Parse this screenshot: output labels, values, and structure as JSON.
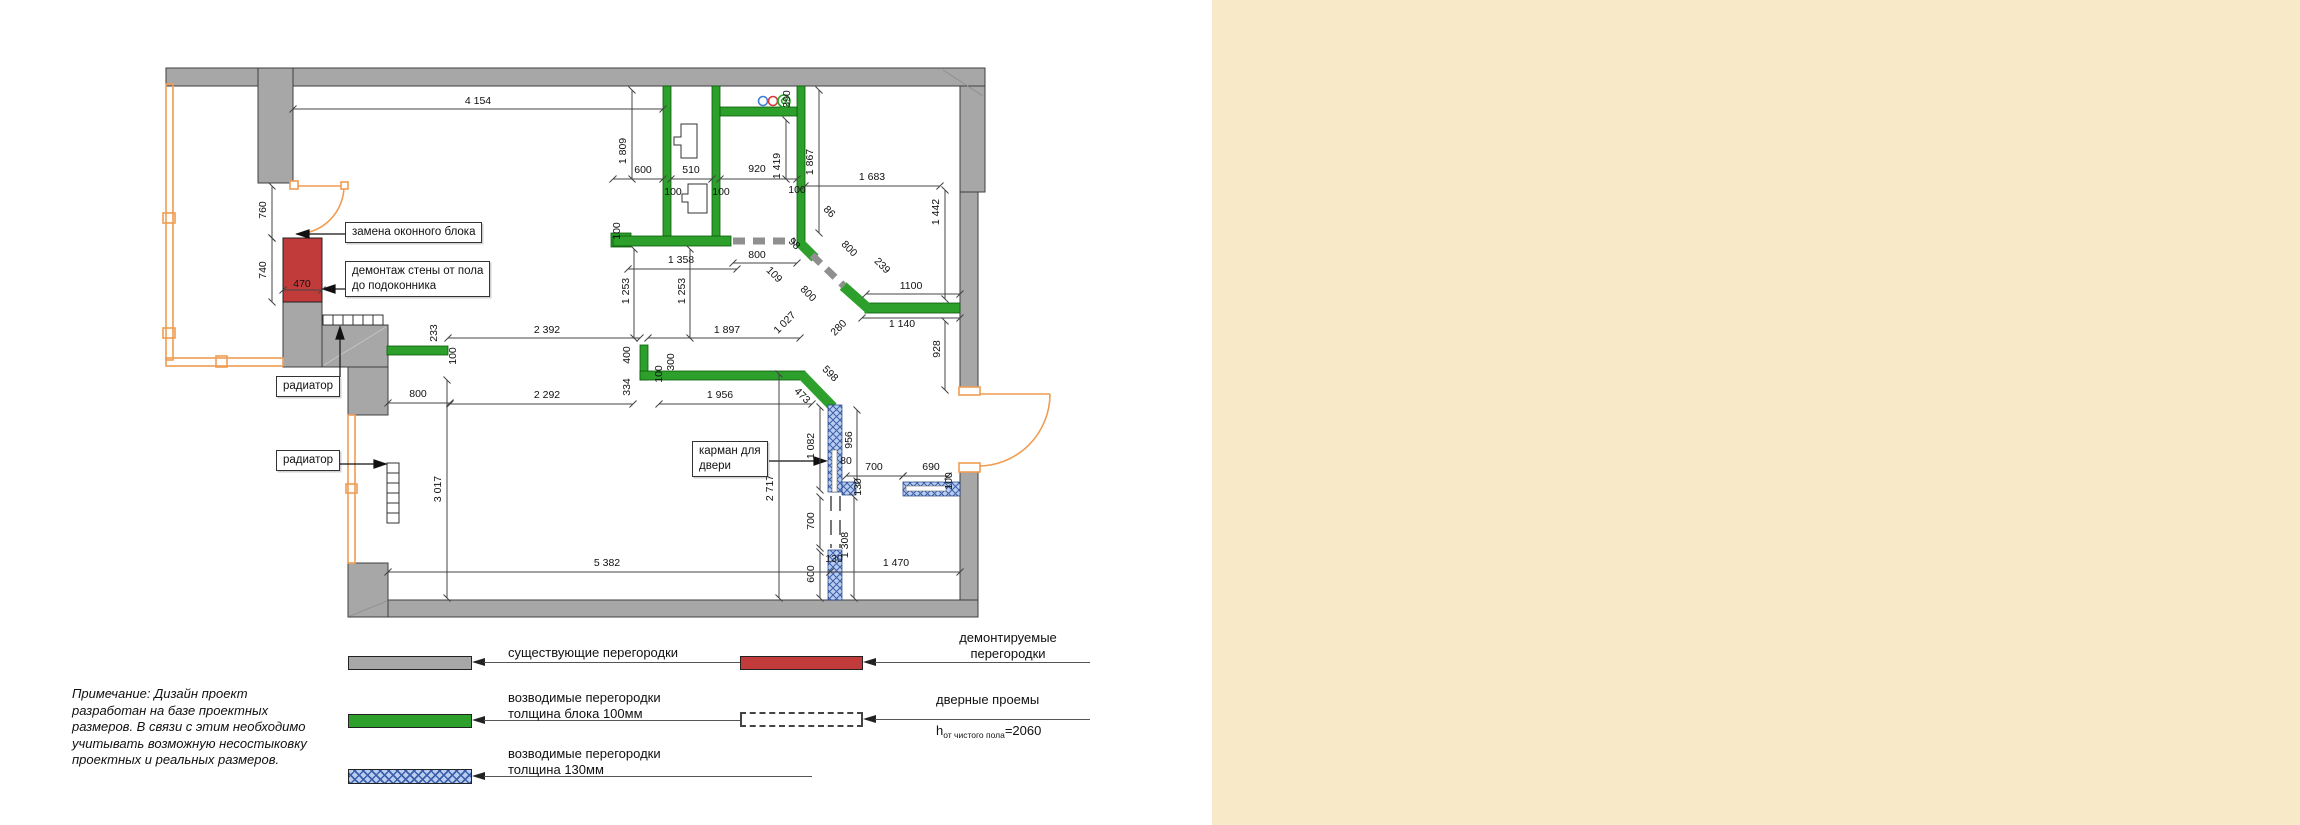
{
  "note": "Примечание: Дизайн проект\nразработан на базе проектных\nразмеров. В связи с этим необходимо\nучитывать возможную несостыковку\nпроектных и реальных размеров.",
  "callouts": {
    "window_block": "замена оконного блока",
    "demolition": "демонтаж стены от пола\nдо подоконника",
    "radiator_top": "радиатор",
    "radiator_left": "радиатор",
    "door_pocket": "карман для\nдвери"
  },
  "legend": {
    "existing": "существующие перегородки",
    "demolished": "демонтируемые\nперегородки",
    "new100": "возводимые перегородки\nтолщина блока 100мм",
    "new130": "возводимые перегородки\nтолщина  130мм",
    "doors": "дверные проемы",
    "doors_h_prefix": "h",
    "doors_h_sub": "от чистого пола",
    "doors_h_value": "=2060"
  },
  "colors": {
    "existing_wall": "#a7a7a7",
    "new_wall_100": "#2da02c",
    "new_wall_130_base": "#b9cdf2",
    "new_wall_130_hatch": "#3b5fa8",
    "demolished_wall": "#c13b3b",
    "window_door": "#f09c52",
    "dimension_text": "#111111",
    "side_panel": "#f8e9c8"
  },
  "plan": {
    "dims": [
      {
        "t": "4 154",
        "x": 478,
        "y": 104,
        "l": [
          293,
          109,
          663,
          109
        ]
      },
      {
        "t": "1 809",
        "x": 626,
        "y": 151,
        "r": -90,
        "l": [
          632,
          90,
          632,
          179
        ]
      },
      {
        "t": "600",
        "x": 643,
        "y": 173,
        "l": [
          613,
          179,
          663,
          179
        ]
      },
      {
        "t": "510",
        "x": 691,
        "y": 173,
        "l": [
          671,
          179,
          712,
          179
        ]
      },
      {
        "t": "100",
        "x": 673,
        "y": 195
      },
      {
        "t": "100",
        "x": 721,
        "y": 195
      },
      {
        "t": "920",
        "x": 757,
        "y": 172,
        "l": [
          720,
          179,
          797,
          179
        ]
      },
      {
        "t": "1 419",
        "x": 780,
        "y": 166,
        "r": -90,
        "l": [
          786,
          120,
          786,
          179
        ]
      },
      {
        "t": "100",
        "x": 797,
        "y": 193
      },
      {
        "t": "390",
        "x": 790,
        "y": 99,
        "r": -90
      },
      {
        "t": "1 867",
        "x": 813,
        "y": 162,
        "r": -90,
        "l": [
          819,
          90,
          819,
          233
        ]
      },
      {
        "t": "1 683",
        "x": 872,
        "y": 180,
        "l": [
          805,
          186,
          940,
          186
        ]
      },
      {
        "t": "1 442",
        "x": 939,
        "y": 212,
        "r": -90,
        "l": [
          945,
          190,
          945,
          299
        ]
      },
      {
        "t": "1 358",
        "x": 681,
        "y": 263,
        "l": [
          628,
          269,
          737,
          269
        ]
      },
      {
        "t": "800",
        "x": 757,
        "y": 258,
        "l": [
          733,
          263,
          797,
          263
        ]
      },
      {
        "t": "98",
        "x": 792,
        "y": 246,
        "r": 45
      },
      {
        "t": "109",
        "x": 772,
        "y": 277,
        "r": 45
      },
      {
        "t": "800",
        "x": 806,
        "y": 296,
        "r": 45
      },
      {
        "t": "1 027",
        "x": 787,
        "y": 325,
        "r": -45
      },
      {
        "t": "280",
        "x": 841,
        "y": 330,
        "r": -45
      },
      {
        "t": "86",
        "x": 827,
        "y": 214,
        "r": 45
      },
      {
        "t": "800",
        "x": 847,
        "y": 251,
        "r": 45
      },
      {
        "t": "239",
        "x": 880,
        "y": 268,
        "r": 45
      },
      {
        "t": "1100",
        "x": 911,
        "y": 289,
        "l": [
          866,
          294,
          960,
          294
        ]
      },
      {
        "t": "1 140",
        "x": 902,
        "y": 327,
        "l": [
          862,
          318,
          960,
          318
        ]
      },
      {
        "t": "928",
        "x": 940,
        "y": 349,
        "r": -90,
        "l": [
          945,
          321,
          945,
          390
        ]
      },
      {
        "t": "598",
        "x": 828,
        "y": 376,
        "r": 45
      },
      {
        "t": "473",
        "x": 800,
        "y": 398,
        "r": 45
      },
      {
        "t": "1 897",
        "x": 727,
        "y": 333,
        "l": [
          648,
          338,
          800,
          338
        ]
      },
      {
        "t": "2 392",
        "x": 547,
        "y": 333,
        "l": [
          448,
          338,
          640,
          338
        ]
      },
      {
        "t": "233",
        "x": 437,
        "y": 333,
        "r": -90
      },
      {
        "t": "100",
        "x": 456,
        "y": 356,
        "r": -90
      },
      {
        "t": "1 253",
        "x": 629,
        "y": 291,
        "r": -90,
        "l": [
          634,
          249,
          634,
          338
        ]
      },
      {
        "t": "1 253",
        "x": 685,
        "y": 291,
        "r": -90,
        "l": [
          690,
          249,
          690,
          338
        ]
      },
      {
        "t": "400",
        "x": 630,
        "y": 355,
        "r": -90
      },
      {
        "t": "334",
        "x": 630,
        "y": 387,
        "r": -90
      },
      {
        "t": "300",
        "x": 674,
        "y": 362,
        "r": -90
      },
      {
        "t": "100",
        "x": 662,
        "y": 374,
        "r": -90
      },
      {
        "t": "2 292",
        "x": 547,
        "y": 398,
        "l": [
          450,
          404,
          633,
          404
        ]
      },
      {
        "t": "1 956",
        "x": 720,
        "y": 398,
        "l": [
          659,
          404,
          812,
          404
        ]
      },
      {
        "t": "800",
        "x": 418,
        "y": 397,
        "l": [
          388,
          403,
          450,
          403
        ]
      },
      {
        "t": "3 017",
        "x": 441,
        "y": 489,
        "r": -90,
        "l": [
          447,
          380,
          447,
          598
        ]
      },
      {
        "t": "2 717",
        "x": 773,
        "y": 488,
        "r": -90,
        "l": [
          779,
          374,
          779,
          598
        ]
      },
      {
        "t": "1 082",
        "x": 814,
        "y": 446,
        "r": -90,
        "l": [
          820,
          407,
          820,
          490
        ]
      },
      {
        "t": "956",
        "x": 852,
        "y": 440,
        "r": -90,
        "l": [
          857,
          410,
          857,
          481
        ]
      },
      {
        "t": "80",
        "x": 846,
        "y": 464
      },
      {
        "t": "130",
        "x": 861,
        "y": 487,
        "r": -90
      },
      {
        "t": "700",
        "x": 874,
        "y": 470,
        "l": [
          846,
          476,
          903,
          476
        ]
      },
      {
        "t": "690",
        "x": 931,
        "y": 470,
        "l": [
          903,
          476,
          948,
          476
        ]
      },
      {
        "t": "100",
        "x": 952,
        "y": 481,
        "r": -90
      },
      {
        "t": "700",
        "x": 814,
        "y": 521,
        "r": -90,
        "l": [
          820,
          497,
          820,
          548
        ]
      },
      {
        "t": "600",
        "x": 814,
        "y": 574,
        "r": -90,
        "l": [
          820,
          552,
          820,
          598
        ]
      },
      {
        "t": "130",
        "x": 834,
        "y": 562
      },
      {
        "t": "1 308",
        "x": 848,
        "y": 545,
        "r": -90,
        "l": [
          854,
          497,
          854,
          598
        ]
      },
      {
        "t": "1 470",
        "x": 896,
        "y": 566,
        "l": [
          830,
          572,
          960,
          572
        ]
      },
      {
        "t": "5 382",
        "x": 607,
        "y": 566,
        "l": [
          388,
          572,
          830,
          572
        ]
      },
      {
        "t": "100",
        "x": 620,
        "y": 231,
        "r": -90
      },
      {
        "t": "760",
        "x": 266,
        "y": 210,
        "r": -90,
        "l": [
          272,
          186,
          272,
          238
        ]
      },
      {
        "t": "740",
        "x": 266,
        "y": 270,
        "r": -90,
        "l": [
          272,
          238,
          272,
          302
        ]
      },
      {
        "t": "470",
        "x": 302,
        "y": 287,
        "l": [
          283,
          290,
          322,
          290
        ]
      }
    ]
  }
}
